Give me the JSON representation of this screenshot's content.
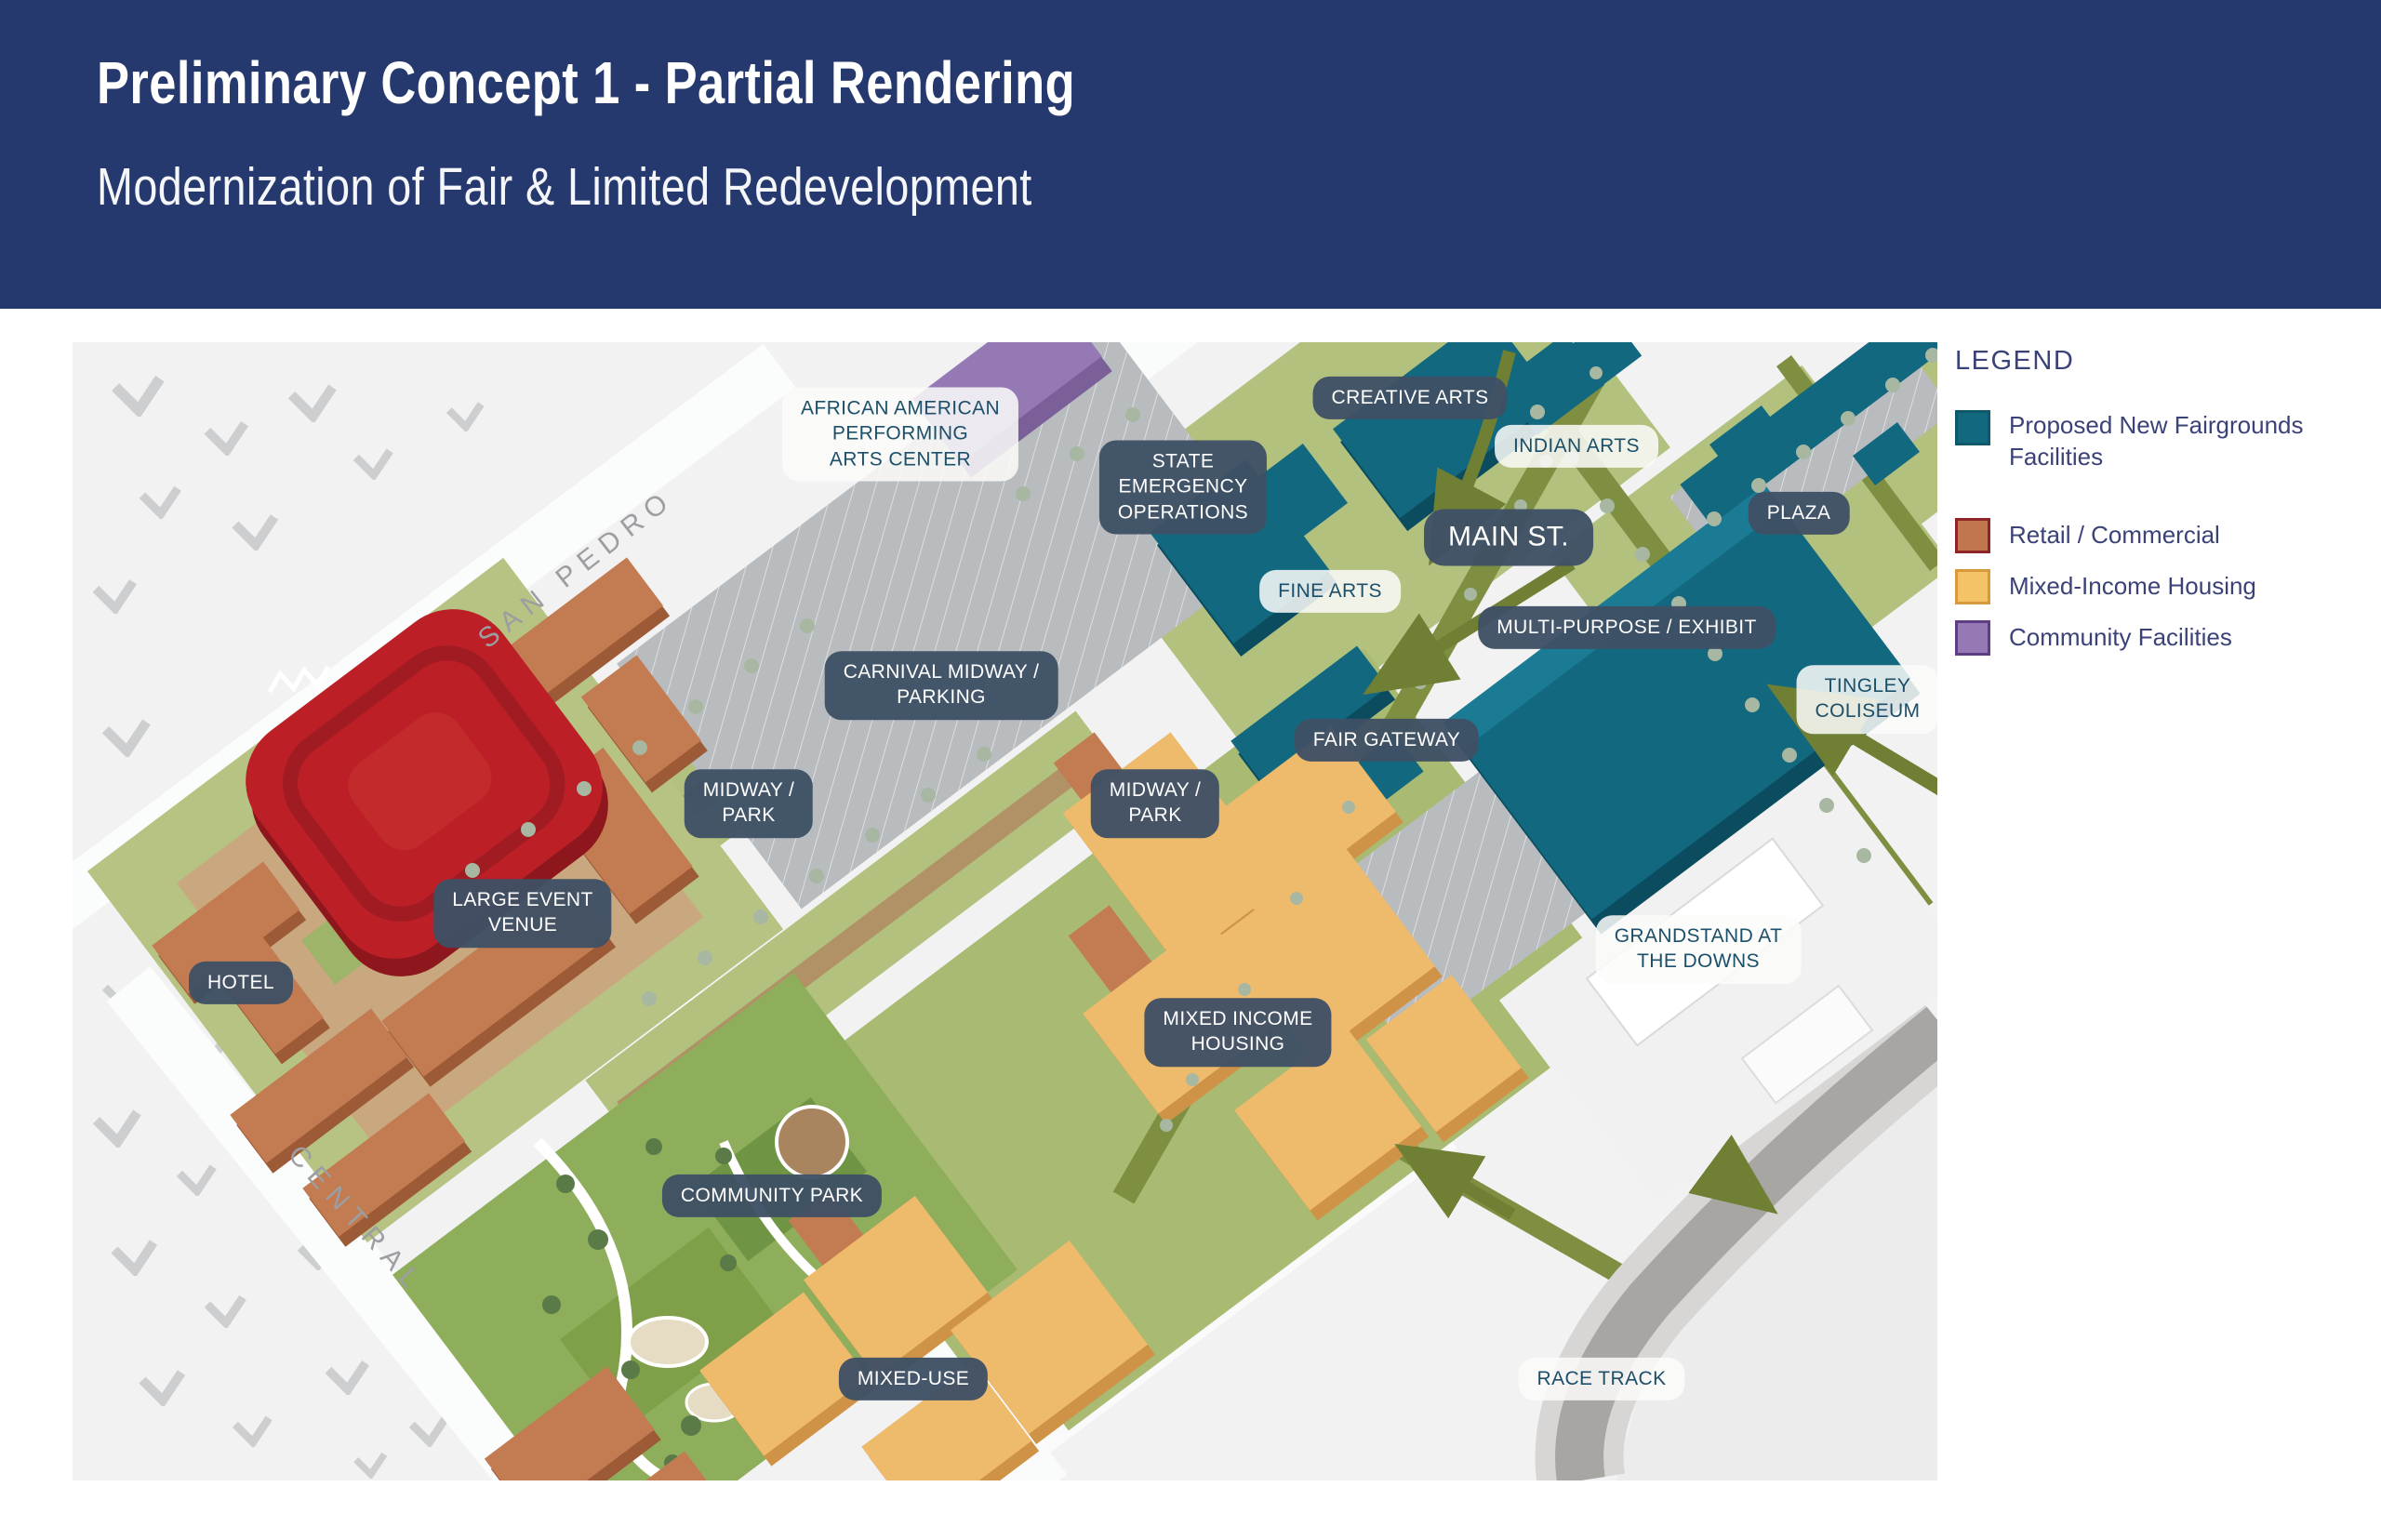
{
  "header": {
    "title": "Preliminary Concept 1 - Partial Rendering",
    "subtitle": "Modernization of Fair & Limited Redevelopment",
    "background": "#26396e"
  },
  "legend": {
    "title": "LEGEND",
    "items": [
      {
        "label": "Proposed New Fairgrounds Facilities",
        "color": "#12687f",
        "border": "#0e586c",
        "swatch_style": "background:#12687f;border-color:#0e586c"
      },
      {
        "label": "Retail / Commercial",
        "color": "#c1764f",
        "border": "#8f2426",
        "swatch_style": "background:#c1764f;border-color:#8f2426"
      },
      {
        "label": "Mixed-Income Housing",
        "color": "#f4c368",
        "border": "#d7993b",
        "swatch_style": "background:#f4c368;border-color:#d7993b"
      },
      {
        "label": "Community Facilities",
        "color": "#9579b5",
        "border": "#5e3d85",
        "swatch_style": "background:#9579b5;border-color:#5e3d85"
      }
    ]
  },
  "map": {
    "street_names": {
      "san_pedro": "SAN PEDRO",
      "central": "CENTRAL"
    },
    "labels": [
      {
        "id": "creative-arts",
        "text": "CREATIVE ARTS"
      },
      {
        "id": "indian-arts",
        "text": "INDIAN ARTS"
      },
      {
        "id": "african-american-performing-arts-center",
        "text": "AFRICAN AMERICAN\nPERFORMING\nARTS CENTER"
      },
      {
        "id": "state-emergency-operations",
        "text": "STATE\nEMERGENCY\nOPERATIONS"
      },
      {
        "id": "main-st",
        "text": "MAIN ST."
      },
      {
        "id": "plaza",
        "text": "PLAZA"
      },
      {
        "id": "fine-arts",
        "text": "FINE ARTS"
      },
      {
        "id": "multi-purpose-exhibit",
        "text": "MULTI-PURPOSE / EXHIBIT"
      },
      {
        "id": "tingley-coliseum",
        "text": "TINGLEY\nCOLISEUM"
      },
      {
        "id": "carnival-midway-parking",
        "text": "CARNIVAL MIDWAY /\nPARKING"
      },
      {
        "id": "fair-gateway",
        "text": "FAIR GATEWAY"
      },
      {
        "id": "midway-park-west",
        "text": "MIDWAY /\nPARK"
      },
      {
        "id": "midway-park-east",
        "text": "MIDWAY /\nPARK"
      },
      {
        "id": "large-event-venue",
        "text": "LARGE EVENT\nVENUE"
      },
      {
        "id": "hotel",
        "text": "HOTEL"
      },
      {
        "id": "grandstand-at-the-downs",
        "text": "GRANDSTAND AT\nTHE DOWNS"
      },
      {
        "id": "mixed-income-housing",
        "text": "MIXED INCOME\nHOUSING"
      },
      {
        "id": "community-park",
        "text": "COMMUNITY PARK"
      },
      {
        "id": "mixed-use",
        "text": "MIXED-USE"
      },
      {
        "id": "race-track",
        "text": "RACE TRACK"
      }
    ]
  },
  "colors": {
    "header_navy": "#26396e",
    "label_pill_navy": "#3e5065",
    "label_light_bg": "#fbfcf9",
    "label_light_text": "#1b4f6a",
    "legend_text": "#3b4277",
    "proposed_teal": "#12687f",
    "retail_terracotta": "#c1764f",
    "housing_amber": "#eeba6b",
    "community_purple": "#9579b5",
    "street_olive": "#7f8f41",
    "park_green": "#8fae5b",
    "parking_gray": "#b9bcbf",
    "racetrack_gray": "#a8a6a3"
  }
}
